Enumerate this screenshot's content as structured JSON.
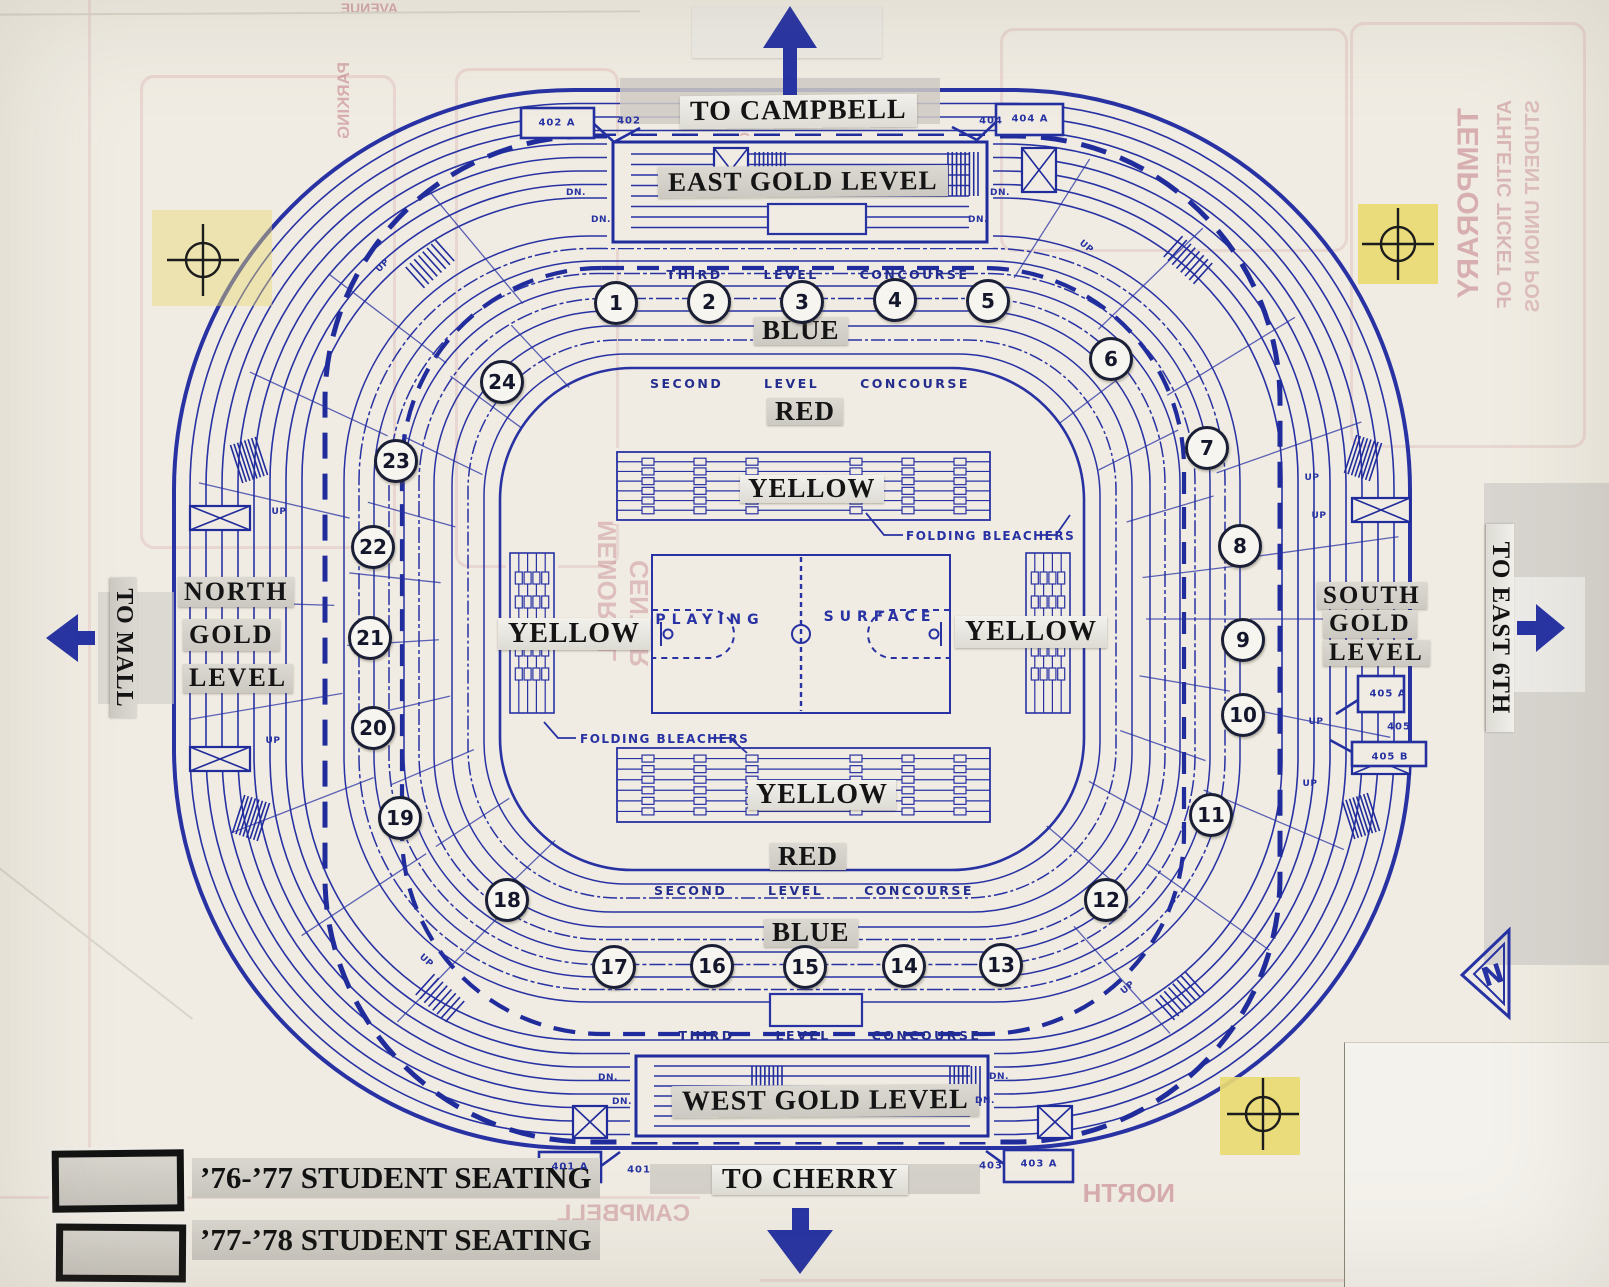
{
  "directions": {
    "top": "TO CAMPBELL",
    "bottom": "TO CHERRY",
    "left": "TO MALL",
    "right": "TO EAST 6TH"
  },
  "gold_levels": {
    "east": "EAST GOLD LEVEL",
    "west": "WEST GOLD LEVEL",
    "north": [
      "NORTH",
      "GOLD",
      "LEVEL"
    ],
    "south": [
      "SOUTH",
      "GOLD",
      "LEVEL"
    ]
  },
  "concourse": {
    "third": "THIRD LEVEL CONCOURSE",
    "second": "SECOND LEVEL CONCOURSE"
  },
  "seat_levels": {
    "blue": "BLUE",
    "red": "RED",
    "yellow": "YELLOW"
  },
  "court": {
    "left": "PLAYING",
    "right": "SURFACE"
  },
  "folding_bleachers": "FOLDING BLEACHERS",
  "compass": "N",
  "legend": {
    "items": [
      {
        "label": "’76-’77 STUDENT SEATING"
      },
      {
        "label": "’77-’78 STUDENT SEATING"
      }
    ]
  },
  "sections": [
    {
      "n": "1",
      "x": 613,
      "y": 300
    },
    {
      "n": "2",
      "x": 706,
      "y": 299
    },
    {
      "n": "3",
      "x": 799,
      "y": 299
    },
    {
      "n": "4",
      "x": 892,
      "y": 297
    },
    {
      "n": "5",
      "x": 985,
      "y": 298
    },
    {
      "n": "6",
      "x": 1108,
      "y": 356
    },
    {
      "n": "7",
      "x": 1204,
      "y": 445
    },
    {
      "n": "8",
      "x": 1237,
      "y": 543
    },
    {
      "n": "9",
      "x": 1240,
      "y": 637
    },
    {
      "n": "10",
      "x": 1240,
      "y": 712
    },
    {
      "n": "11",
      "x": 1208,
      "y": 812
    },
    {
      "n": "12",
      "x": 1103,
      "y": 897
    },
    {
      "n": "13",
      "x": 998,
      "y": 962
    },
    {
      "n": "14",
      "x": 901,
      "y": 963
    },
    {
      "n": "15",
      "x": 802,
      "y": 964
    },
    {
      "n": "16",
      "x": 709,
      "y": 963
    },
    {
      "n": "17",
      "x": 611,
      "y": 964
    },
    {
      "n": "18",
      "x": 504,
      "y": 897
    },
    {
      "n": "19",
      "x": 397,
      "y": 815
    },
    {
      "n": "20",
      "x": 370,
      "y": 725
    },
    {
      "n": "21",
      "x": 367,
      "y": 635
    },
    {
      "n": "22",
      "x": 370,
      "y": 544
    },
    {
      "n": "23",
      "x": 393,
      "y": 458
    },
    {
      "n": "24",
      "x": 499,
      "y": 379
    }
  ],
  "doors": [
    {
      "label": "402 A",
      "x": 557,
      "y": 123
    },
    {
      "label": "402",
      "x": 629,
      "y": 121
    },
    {
      "label": "404",
      "x": 991,
      "y": 121
    },
    {
      "label": "404 A",
      "x": 1030,
      "y": 119
    },
    {
      "label": "401 A",
      "x": 570,
      "y": 1167
    },
    {
      "label": "401",
      "x": 639,
      "y": 1170
    },
    {
      "label": "403",
      "x": 991,
      "y": 1166
    },
    {
      "label": "403 A",
      "x": 1039,
      "y": 1164
    },
    {
      "label": "405 A",
      "x": 1388,
      "y": 694
    },
    {
      "label": "405",
      "x": 1399,
      "y": 727
    },
    {
      "label": "405 B",
      "x": 1390,
      "y": 757
    }
  ],
  "stairs": {
    "up": "UP",
    "dn": "DN.",
    "up_positions": [
      [
        383,
        266,
        -45
      ],
      [
        279,
        512,
        0
      ],
      [
        273,
        741,
        0
      ],
      [
        1086,
        247,
        40
      ],
      [
        1312,
        478,
        0
      ],
      [
        1319,
        516,
        0
      ],
      [
        1316,
        722,
        0
      ],
      [
        1310,
        784,
        0
      ],
      [
        426,
        961,
        42
      ],
      [
        1128,
        988,
        -40
      ]
    ],
    "dn_positions": [
      [
        576,
        193,
        0
      ],
      [
        601,
        220,
        0
      ],
      [
        1000,
        193,
        0
      ],
      [
        978,
        220,
        0
      ],
      [
        608,
        1078,
        0
      ],
      [
        622,
        1102,
        0
      ],
      [
        999,
        1077,
        0
      ],
      [
        985,
        1101,
        0
      ]
    ]
  },
  "bleedthrough": [
    {
      "text": "AVENUE",
      "x": 398,
      "y": 0,
      "size": 14,
      "opacity": 0.45,
      "kind": "m"
    },
    {
      "text": "PARKING",
      "x": 334,
      "y": 62,
      "size": 17,
      "opacity": 0.4,
      "kind": "vm"
    },
    {
      "text": "CHERRY",
      "x": 737,
      "y": 132,
      "size": 16,
      "opacity": 0.32,
      "kind": "vm"
    },
    {
      "text": "TEMPORARY",
      "x": 1452,
      "y": 108,
      "size": 30,
      "opacity": 0.4,
      "kind": "vm"
    },
    {
      "text": "ATHLETIC TICKET OF",
      "x": 1494,
      "y": 100,
      "size": 20,
      "opacity": 0.35,
      "kind": "vm"
    },
    {
      "text": "STUDENT UNION POS",
      "x": 1522,
      "y": 100,
      "size": 20,
      "opacity": 0.3,
      "kind": "vm"
    },
    {
      "text": "MEMORIAL",
      "x": 592,
      "y": 520,
      "size": 26,
      "opacity": 0.3,
      "kind": "vm"
    },
    {
      "text": "CENTER",
      "x": 624,
      "y": 560,
      "size": 26,
      "opacity": 0.3,
      "kind": "vm"
    },
    {
      "text": "CAMPBELL",
      "x": 690,
      "y": 1200,
      "size": 24,
      "opacity": 0.35,
      "kind": "m"
    },
    {
      "text": "NORTH",
      "x": 1175,
      "y": 1178,
      "size": 26,
      "opacity": 0.42,
      "kind": "m"
    }
  ],
  "colors": {
    "blueprint": "#2832a3",
    "blueprint_bold": "#202c9b",
    "paper": "#f0ece3",
    "label_bg": "#d2cfc8",
    "tag_yellow": "#e9da72",
    "bleed_pink": "#b45668",
    "patch_gray": "#d8d5d0",
    "ink": "#141414"
  }
}
